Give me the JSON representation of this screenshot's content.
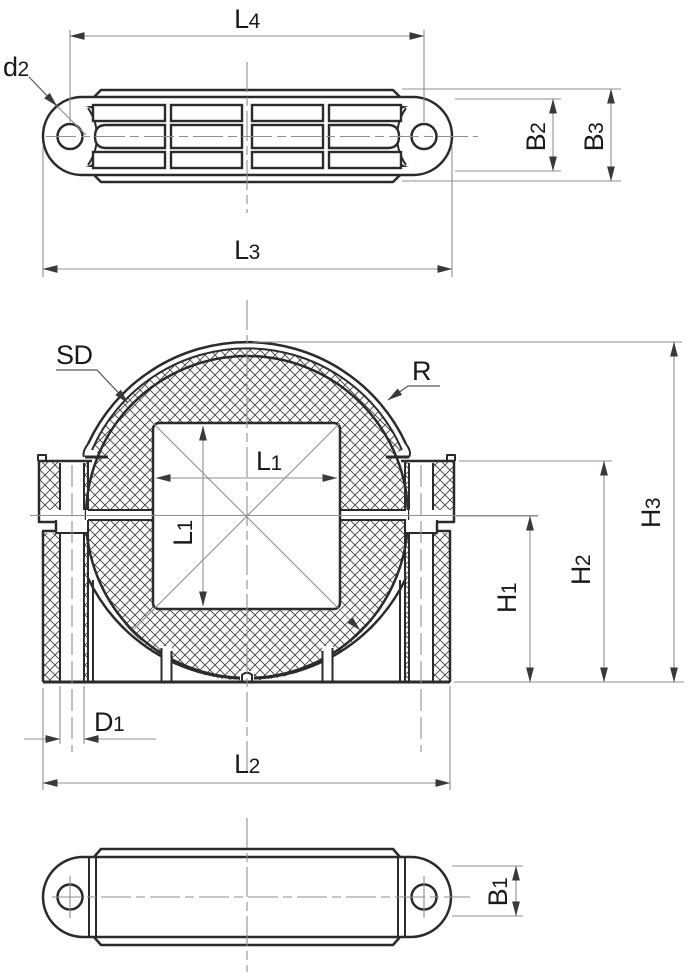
{
  "drawing": {
    "background": "#ffffff",
    "outline_color": "#2e2a27",
    "thin_line_color": "#8f8f8f",
    "hatch_color": "#403c3a",
    "arrow_color": "#3c3835",
    "text_color": "#1a1a1a"
  },
  "labels": {
    "top_view": {
      "L4": {
        "main": "L",
        "sub": "4"
      },
      "d2": {
        "main": "d",
        "sub": "2"
      },
      "L3": {
        "main": "L",
        "sub": "3"
      },
      "B2": {
        "main": "B",
        "sub": "2"
      },
      "B3": {
        "main": "B",
        "sub": "3"
      }
    },
    "front_view": {
      "SD": "SD",
      "R": "R",
      "L1_horizontal": {
        "main": "L",
        "sub": "1"
      },
      "L1_vertical": {
        "main": "L",
        "sub": "1"
      },
      "H1": {
        "main": "H",
        "sub": "1"
      },
      "H2": {
        "main": "H",
        "sub": "2"
      },
      "H3": {
        "main": "H",
        "sub": "3"
      },
      "D1": {
        "main": "D",
        "sub": "1"
      },
      "L2": {
        "main": "L",
        "sub": "2"
      }
    },
    "bottom_view": {
      "B1": {
        "main": "B",
        "sub": "1"
      }
    }
  }
}
